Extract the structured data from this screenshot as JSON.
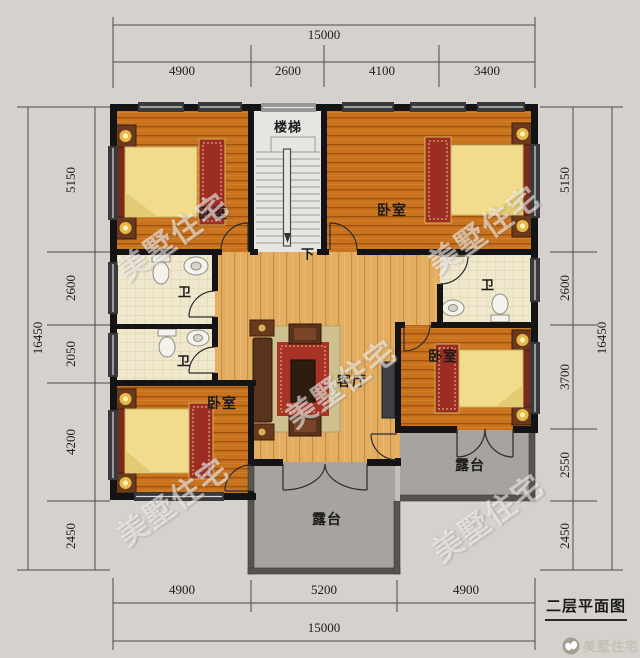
{
  "title": "二层平面图",
  "watermark": {
    "text": "美墅住宅",
    "brand": "美墅住宅"
  },
  "rooms": {
    "stairs": "楼梯",
    "down": "下",
    "bedroom": "卧室",
    "bathroom": "卫",
    "living_room": "客厅",
    "terrace": "露台"
  },
  "dimensions": {
    "top": {
      "total": "15000",
      "segments": [
        "4900",
        "2600",
        "4100",
        "3400"
      ]
    },
    "bottom": {
      "total": "15000",
      "segments": [
        "4900",
        "5200",
        "4900"
      ]
    },
    "left": {
      "total": "16450",
      "segments": [
        "5150",
        "2600",
        "2050",
        "4200",
        "2450"
      ]
    },
    "right": {
      "total": "16450",
      "segments": [
        "5150",
        "2600",
        "3700",
        "2550",
        "2450"
      ]
    }
  },
  "colors": {
    "background": "#d5d1cc",
    "bedroom_floor": "#c9731f",
    "hall_floor": "#e4ae62",
    "bathroom_floor": "#efe8cd",
    "terrace_floor": "#a7a39e",
    "wall": "#141414",
    "bed": "#f0dc8c",
    "rug": "#a93226"
  }
}
